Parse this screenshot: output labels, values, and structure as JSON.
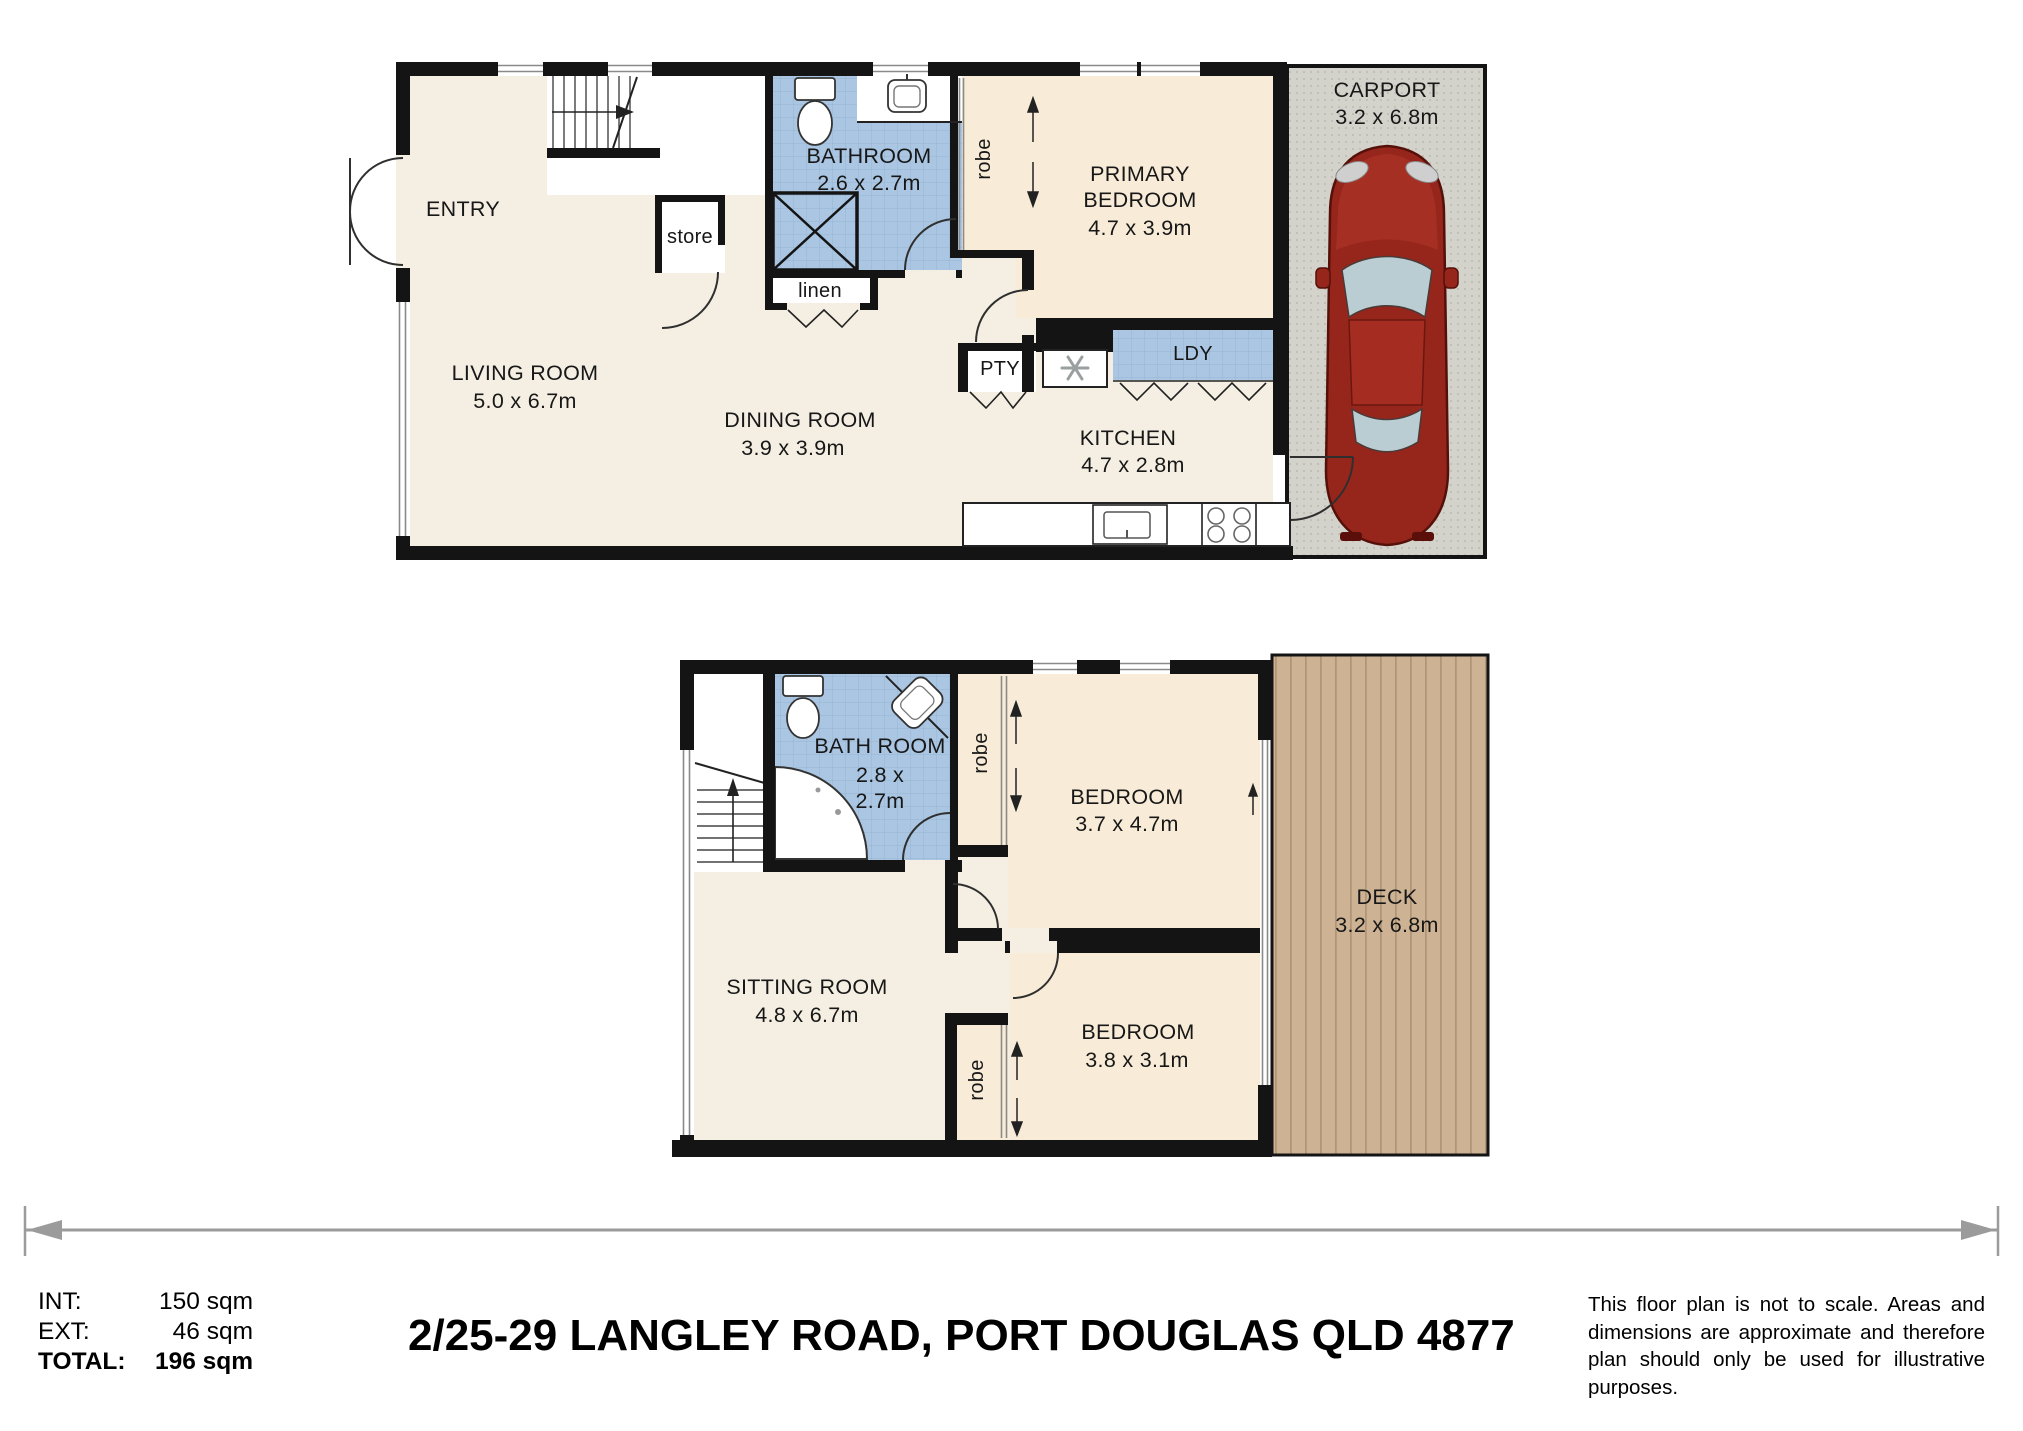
{
  "title": "2/25-29 LANGLEY ROAD, PORT DOUGLAS QLD 4877",
  "disclaimer": "This floor plan is not to scale. Areas and dimensions are approximate and therefore plan should only be used for illustrative purposes.",
  "area_summary": {
    "int_label": "INT:",
    "int_value": "150 sqm",
    "ext_label": "EXT:",
    "ext_value": "46 sqm",
    "total_label": "TOTAL:",
    "total_value": "196 sqm"
  },
  "upper_floor": {
    "entry": "ENTRY",
    "living_name": "LIVING ROOM",
    "living_dims": "5.0 x 6.7m",
    "dining_name": "DINING ROOM",
    "dining_dims": "3.9 x 3.9m",
    "bathroom_name": "BATHROOM",
    "bathroom_dims": "2.6 x 2.7m",
    "store": "store",
    "linen": "linen",
    "robe": "robe",
    "primary_name": "PRIMARY BEDROOM",
    "primary_dims": "4.7 x 3.9m",
    "pty": "PTY",
    "ldy": "LDY",
    "kitchen_name": "KITCHEN",
    "kitchen_dims": "4.7 x 2.8m",
    "carport_name": "CARPORT",
    "carport_dims": "3.2 x 6.8m"
  },
  "lower_floor": {
    "bathroom_name": "BATH ROOM",
    "bathroom_dims": "2.8 x 2.7m",
    "robe_top": "robe",
    "bedroom1_name": "BEDROOM",
    "bedroom1_dims": "3.7 x 4.7m",
    "deck_name": "DECK",
    "deck_dims": "3.2 x 6.8m",
    "sitting_name": "SITTING ROOM",
    "sitting_dims": "4.8 x 6.7m",
    "robe_bottom": "robe",
    "bedroom2_name": "BEDROOM",
    "bedroom2_dims": "3.8 x 3.1m"
  },
  "colors": {
    "wall": "#141414",
    "cream": "#f5efe3",
    "bedroom_cream": "#f8ecd8",
    "tile_blue": "#aac6e2",
    "tile_line": "#96b4d2",
    "carport_gray": "#d3d3cb",
    "deck_tan": "#cdb394",
    "window_gray": "#8a8a8a",
    "scale_gray": "#9b9b9b",
    "car_red": "#96261c"
  }
}
